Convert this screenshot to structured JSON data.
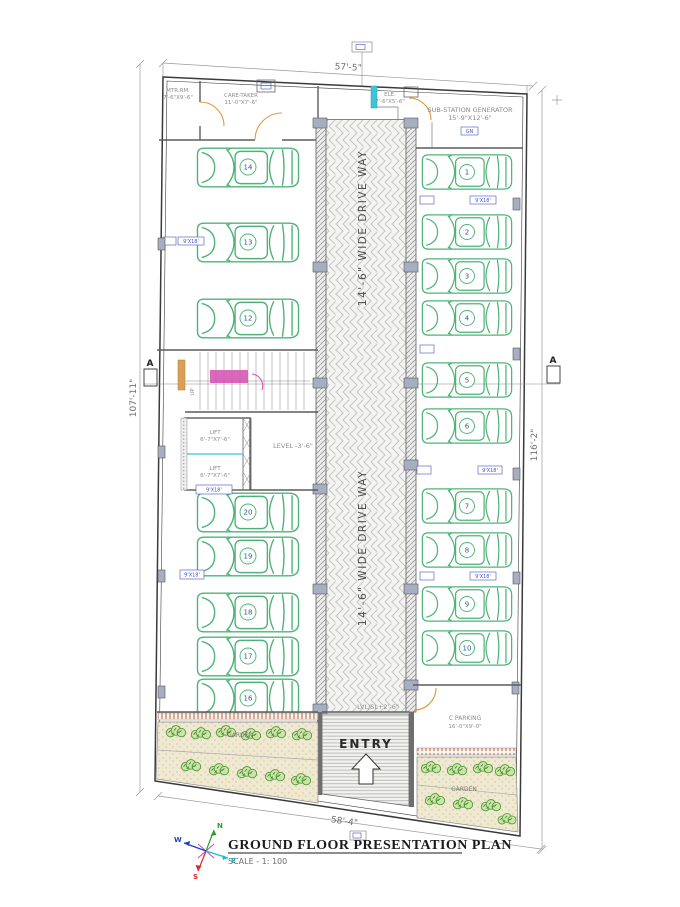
{
  "title_block": {
    "title": "GROUND FLOOR PRESENTATION PLAN",
    "scale": "SCALE - 1: 100"
  },
  "dims": {
    "top": "57'-5\"",
    "bottom": "58'-4\"",
    "left": "107'-11\"",
    "right": "116'-2\""
  },
  "driveway": {
    "label": "14'-6\" WIDE DRIVE WAY",
    "entry": "ENTRY",
    "ramp_level": "LVL/SL+2'-6\"",
    "level": "LEVEL -3'-6\""
  },
  "rooms": {
    "meter": {
      "name": "MTR.RM.",
      "size": "7'-6\"X9'-6\""
    },
    "caretaker": {
      "name": "CARE-TAKER",
      "size": "11'-0\"X7'-6\""
    },
    "ele": {
      "name": "ELE.",
      "size": "7'-6\"X5'-6\""
    },
    "substation": {
      "name": "SUB-STATION GENERATOR",
      "size": "15'-9\"X12'-6\""
    },
    "cparking": {
      "name": "C PARKING",
      "size": "16'-0\"X9'-0\""
    },
    "lift": {
      "name": "LIFT",
      "size": "6'-7\"X7'-6\""
    }
  },
  "stairs": {
    "up": "UP"
  },
  "section": {
    "label": "A"
  },
  "garden": {
    "label": "GARDEN"
  },
  "tags": {
    "stall": "9'X18'",
    "generator": "GN"
  },
  "cars": {
    "right": [
      "1",
      "2",
      "3",
      "4",
      "5",
      "6",
      "7",
      "8",
      "9",
      "10"
    ],
    "left_top": [
      "14",
      "13",
      "12"
    ],
    "left_bottom": [
      "20",
      "19",
      "18",
      "17",
      "16"
    ]
  },
  "compass": {
    "n": "N",
    "s": "S",
    "e": "E",
    "w": "W"
  },
  "colors": {
    "car": "#4fb379",
    "door": "#e09a3c",
    "stair_highlight": "#d44fb0",
    "cyan": "#3fc3d6",
    "tag_blue": "#4353c4",
    "wall": "#5c5c5c",
    "dim": "#9a9a9a",
    "garden_bg": "#f0e9d2",
    "plant": "#4a9a3a"
  }
}
